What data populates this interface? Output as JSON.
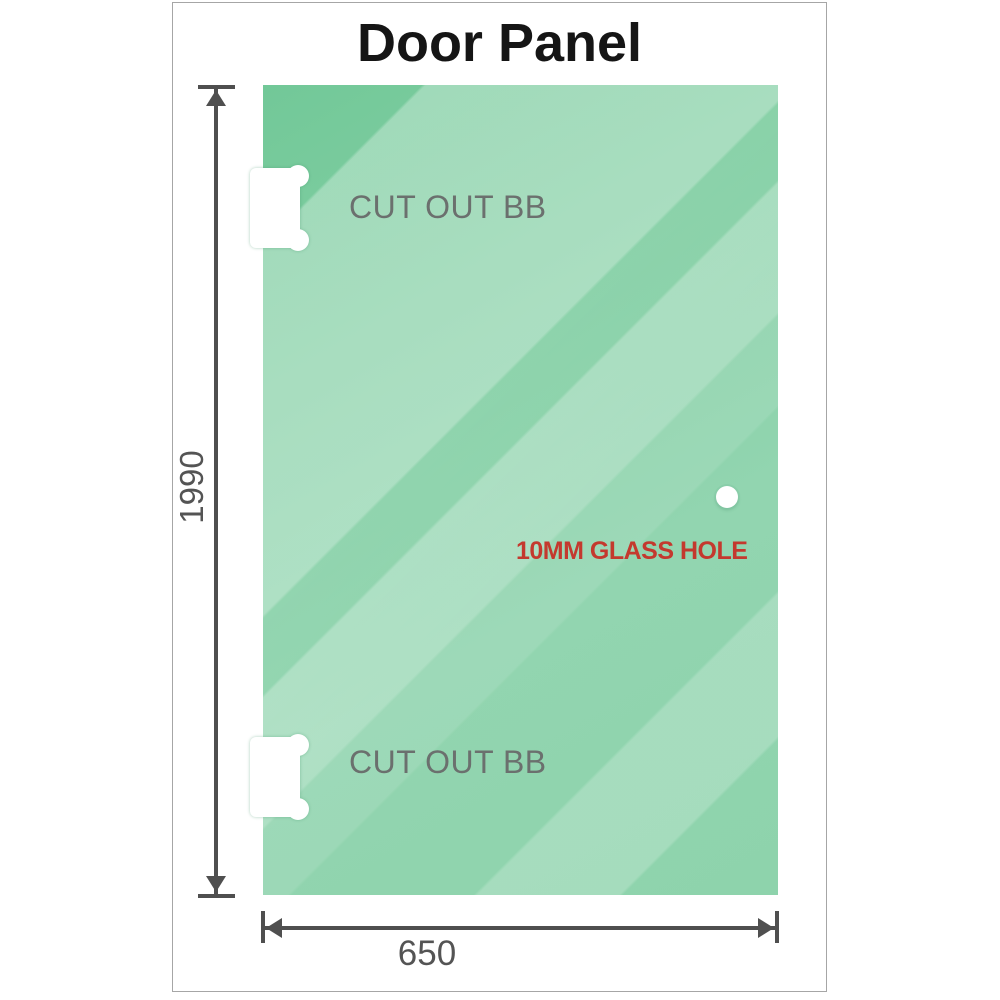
{
  "title": "Door Panel",
  "panel": {
    "description": "Green glass shower door panel, front elevation",
    "cutouts": [
      {
        "label": "CUT OUT BB",
        "position": "top-left"
      },
      {
        "label": "CUT OUT BB",
        "position": "bottom-left"
      }
    ],
    "hole": {
      "label": "10MM GLASS HOLE",
      "position": "middle-right"
    }
  },
  "dimensions": {
    "height": {
      "value": "1990",
      "orientation": "vertical",
      "side": "left"
    },
    "width": {
      "value": "650",
      "orientation": "horizontal",
      "side": "bottom"
    }
  },
  "colors": {
    "glass_dark": "#72c898",
    "glass_mid": "#8fd2ab",
    "glass_light": "#aadfc2",
    "dimension_line": "#4f4f4f",
    "dimension_text": "#545454",
    "cutout_label_text": "#6b706e",
    "hole_label_text": "#c4392e",
    "title_text": "#151515",
    "frame_border": "#a6a6a6"
  },
  "icons": {
    "cutout": "hinge-cutout-icon",
    "glass_hole": "glass-hole-icon",
    "arrow_up": "arrow-up-icon",
    "arrow_down": "arrow-down-icon",
    "arrow_left": "arrow-left-icon",
    "arrow_right": "arrow-right-icon"
  }
}
